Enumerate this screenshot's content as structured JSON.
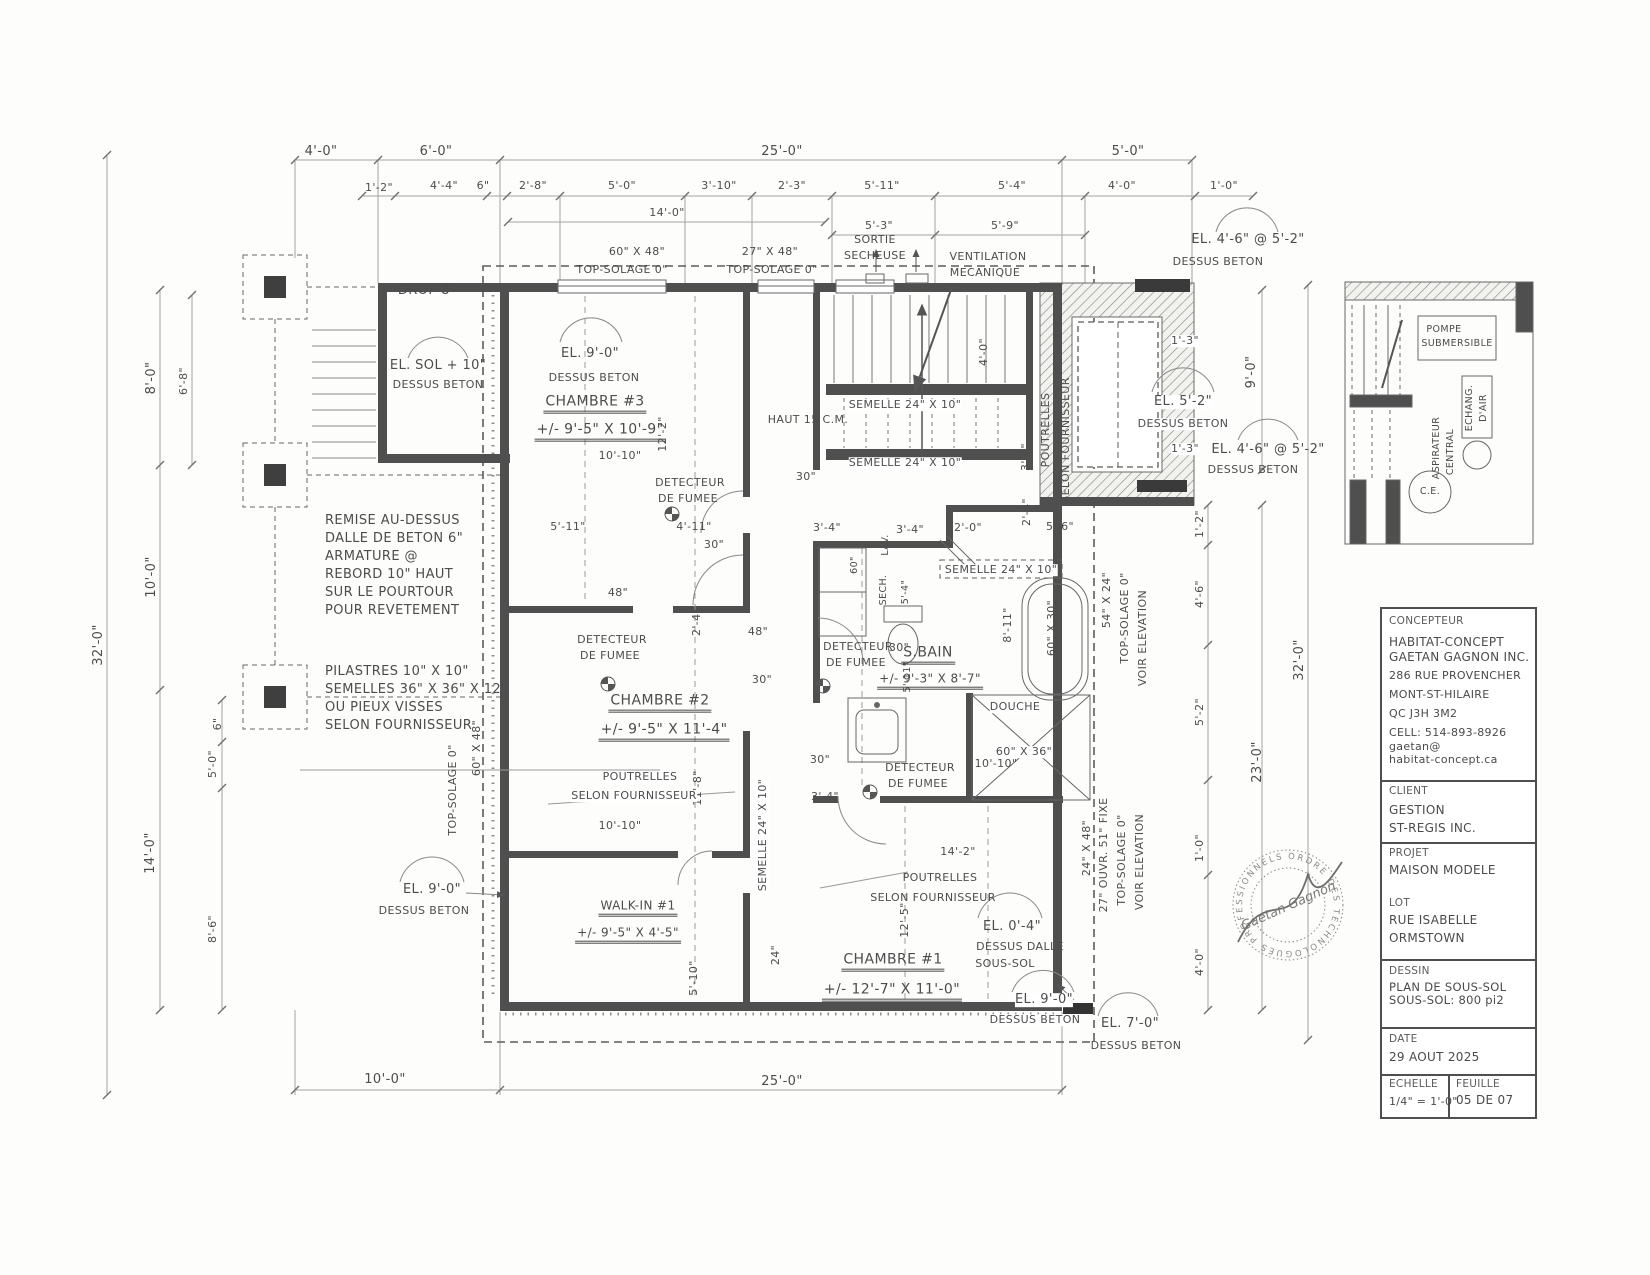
{
  "title_block": {
    "concepteur_label": "CONCEPTEUR",
    "concepteur_lines": [
      "HABITAT-CONCEPT",
      "GAETAN GAGNON INC.",
      "286 RUE PROVENCHER",
      "MONT-ST-HILAIRE",
      "QC J3H 3M2",
      "CELL: 514-893-8926",
      "gaetan@",
      "habitat-concept.ca"
    ],
    "client_label": "CLIENT",
    "client_lines": [
      "GESTION",
      "ST-REGIS INC."
    ],
    "projet_label": "PROJET",
    "projet": "MAISON MODELE",
    "lot_label": "LOT",
    "lot_lines": [
      "RUE ISABELLE",
      "ORMSTOWN"
    ],
    "dessin_label": "DESSIN",
    "dessin_lines": [
      "PLAN DE SOUS-SOL",
      "SOUS-SOL:    800 pi2"
    ],
    "date_label": "DATE",
    "date": "29 AOUT 2025",
    "echelle_label": "ECHELLE",
    "echelle": "1/4\" = 1'-0\"",
    "feuille_label": "FEUILLE",
    "feuille": "05 DE 07"
  },
  "stamp": {
    "ring": "ORDRE DES TECHNOLOGUES PROFESSIONNELS",
    "name": "Gaetan Gagnon"
  },
  "detail": {
    "pompe1": "POMPE",
    "pompe2": "SUBMERSIBLE",
    "echang": "ECHANG.",
    "dair": "D'AIR",
    "asp1": "ASPIRATEUR",
    "asp2": "CENTRAL",
    "ce": "C.E."
  },
  "dims": {
    "top1": [
      "4'-0\"",
      "6'-0\"",
      "25'-0\"",
      "5'-0\""
    ],
    "top2": [
      "1'-2\"",
      "4'-4\"",
      "6\"",
      "2'-8\"",
      "5'-0\"",
      "3'-10\"",
      "2'-3\"",
      "5'-11\"",
      "5'-4\"",
      "4'-0\"",
      "1'-0\""
    ],
    "top3": [
      "14'-0\"",
      "5'-3\"",
      "5'-9\""
    ],
    "left": [
      "8'-0\"",
      "6'-8\"",
      "10'-0\"",
      "32'-0\"",
      "6\"",
      "5'-0\"",
      "14'-0\"",
      "8'-6\""
    ],
    "right": [
      "9'-0\"",
      "1'-2\"",
      "4'-6\"",
      "5'-2\"",
      "23'-0\"",
      "1'-0\"",
      "4'-0\"",
      "32'-0\""
    ],
    "bottom": [
      "10'-0\"",
      "25'-0\""
    ]
  },
  "rooms": {
    "c3n": "CHAMBRE #3",
    "c3s": "+/- 9'-5\" X 10'-9\"",
    "c2n": "CHAMBRE #2",
    "c2s": "+/- 9'-5\" X 11'-4\"",
    "c1n": "CHAMBRE #1",
    "c1s": "+/- 12'-7\" X 11'-0\"",
    "wn": "WALK-IN #1",
    "ws": "+/- 9'-5\" X 4'-5\"",
    "bn": "S.BAIN",
    "bs": "+/- 9'-3\" X 8'-7\"",
    "douche": "DOUCHE",
    "douche_size": "60\" X 36\"",
    "bain_size": "60\" X 30\""
  },
  "els": {
    "sol": "EL. SOL + 10\"",
    "e9": "EL. 9'-0\"",
    "e52": "EL. 5'-2\"",
    "e46": "EL. 4'-6\" @ 5'-2\"",
    "e04": "EL. 0'-4\"",
    "e7": "EL. 7'-0\"",
    "beton": "DESSUS BETON",
    "dalle": "DESSUS DALLE",
    "sous_sol": "SOUS-SOL"
  },
  "notes": {
    "drop": "DROP 8\"",
    "remise": [
      "REMISE AU-DESSUS",
      "DALLE DE BETON 6\"",
      "ARMATURE @",
      "REBORD 10\" HAUT",
      "SUR LE POURTOUR",
      "POUR REVETEMENT"
    ],
    "pilastres": [
      "PILASTRES 10\" X 10\"",
      "SEMELLES 36\" X 36\" X 12\"",
      "OU PIEUX VISSES",
      "SELON FOURNISSEUR"
    ],
    "top_solage": "TOP-SOLAGE 0\"",
    "w60": "60\" X 48\"",
    "w27": "27\" X 48\"",
    "sortie": "SORTIE",
    "secheuse": "SECHEUSE",
    "vent": "VENTILATION",
    "mec": "MECANIQUE",
    "detecteur": "DETECTEUR",
    "fumee": "DE FUMEE",
    "haut": "HAUT 15 C.M.",
    "semelle": "SEMELLE 24\" X 10\"",
    "poutrelles": "POUTRELLES",
    "selon": "SELON FOURNISSEUR",
    "t54": "54\" X 24\"",
    "t24x48": "24\" X 48\"",
    "t27ouvr": "27\" OUVR. 51\" FIXE",
    "voir": "VOIR ELEVATION",
    "sech": "SECH.",
    "lav": "LAV."
  },
  "meas": {
    "m10_10": "10'-10\"",
    "m12_2": "12'-2\"",
    "m5_11": "5'-11\"",
    "m4_11": "4'-11\"",
    "m30": "30\"",
    "m48": "48\"",
    "m2_4": "2'-4\"",
    "m4_0": "4'-0\"",
    "m3_6": "3'-6\"",
    "m5_6": "5'-6\"",
    "m3_4": "3'-4\"",
    "m2_0": "2'-0\"",
    "m5_4": "5'-4\"",
    "m60": "60\"",
    "m8_11": "8'-11\"",
    "m11_8": "11'-8\"",
    "m14_2": "14'-2\"",
    "m12_5": "12'-5\"",
    "m5_10": "5'-10\"",
    "m24": "24\"",
    "m1_3": "1'-3\""
  }
}
